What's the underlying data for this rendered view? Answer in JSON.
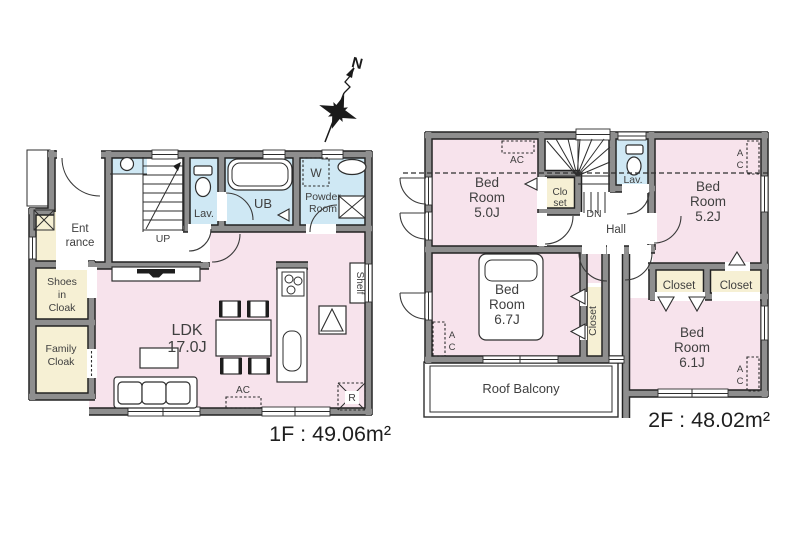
{
  "compass": {
    "north": "N"
  },
  "floor1": {
    "area": "1F : 49.06m²",
    "entrance": [
      "Ent",
      "rance"
    ],
    "shoes_cloak": [
      "Shoes",
      "in",
      "Cloak"
    ],
    "family_cloak": [
      "Family",
      "Cloak"
    ],
    "ldk": [
      "LDK",
      "17.0J"
    ],
    "lav": "Lav.",
    "ub": "UB",
    "powder_room": [
      "Powder",
      "Room"
    ],
    "up": "UP",
    "washer": "W",
    "shelf": "Shelf",
    "ac": "AC",
    "fridge": "R"
  },
  "floor2": {
    "area": "2F : 48.02m²",
    "bedroom_50": [
      "Bed",
      "Room",
      "5.0J"
    ],
    "bedroom_52": [
      "Bed",
      "Room",
      "5.2J"
    ],
    "bedroom_67": [
      "Bed",
      "Room",
      "6.7J"
    ],
    "bedroom_61": [
      "Bed",
      "Room",
      "6.1J"
    ],
    "closet_stairs": [
      "Clo",
      "set"
    ],
    "closet": "Closet",
    "lav": "Lav.",
    "hall": "Hall",
    "dn": "DN",
    "roof_balcony": "Roof Balcony",
    "ac": "AC",
    "ac_v": [
      "A",
      "C"
    ]
  },
  "colors": {
    "room_pink": "#f7e3ec",
    "wet_blue": "#cfe8f4",
    "storage_cream": "#f6f0d4",
    "wall_gray": "#8e8e8e",
    "line_black": "#222222"
  }
}
